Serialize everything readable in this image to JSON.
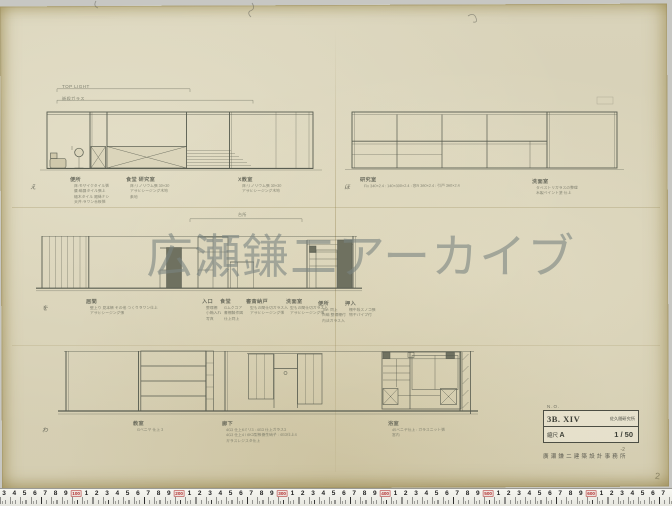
{
  "watermark": "広瀬鎌二アーカイブ",
  "dim_labels": [
    {
      "x": 62,
      "y": 84,
      "fs": 4.6,
      "text": "TOP LIGHT"
    },
    {
      "x": 62,
      "y": 95.5,
      "fs": 4.2,
      "text": "嵌殺ガラス"
    },
    {
      "x": 238,
      "y": 212,
      "fs": 4,
      "text": "台所"
    }
  ],
  "annotations": [
    {
      "x": 30,
      "y": 176,
      "mark": "え"
    },
    {
      "x": 70,
      "y": 176,
      "label": "便所",
      "notes": [
        "床:モザイクタイル張",
        "腰:磁器タイル張上",
        "幅木タイル 廻縁ナシ",
        "天井:ラワン合板張"
      ]
    },
    {
      "x": 126,
      "y": 176,
      "label": "食堂 研究室",
      "notes": [
        "床:リノリウム張 30×30",
        "アサヒシージング木地",
        "素地"
      ]
    },
    {
      "x": 238,
      "y": 176,
      "label": "X教室",
      "notes": [
        "床:リノリウム張 30×30",
        "アサヒシージング木地"
      ]
    },
    {
      "x": 344,
      "y": 176,
      "mark": "ほ"
    },
    {
      "x": 360,
      "y": 176,
      "label": "研究室",
      "notes": [
        "Fix 340×2.4 : 140×300×2.4 : 窓R 360×2.4 : 引戸 360×2.4"
      ]
    },
    {
      "x": 532,
      "y": 178,
      "label": "洗面室",
      "notes": [
        "タペストリガラスの整理",
        "木製ペイント塗 仕上"
      ]
    },
    {
      "x": 42,
      "y": 297,
      "mark": "を"
    },
    {
      "x": 86,
      "y": 298,
      "label": "居間",
      "notes": [
        "壁上り 見本帳 その他 つくりラワン仕上",
        "アサヒシージング張"
      ]
    },
    {
      "x": 202,
      "y": 298,
      "label": "入口",
      "notes": [
        "整理棚",
        "小箱入れ",
        "写真"
      ]
    },
    {
      "x": 220,
      "y": 298,
      "label": "食堂",
      "notes": [
        "Gムクコア",
        "書棚製作図",
        "仕上同上"
      ]
    },
    {
      "x": 246,
      "y": 298,
      "label": "書斎納戸",
      "notes": [
        "型もの間仕切ガラス入",
        "アサヒシージング張"
      ]
    },
    {
      "x": 286,
      "y": 298,
      "label": "洗面室",
      "notes": [
        "型もの間仕切ガラス入",
        "アサヒシージング張"
      ]
    },
    {
      "x": 318,
      "y": 300,
      "label": "便所",
      "notes": [
        "Tile: 同上",
        "白磁 整理棚付",
        "内法ガラス入"
      ]
    },
    {
      "x": 345,
      "y": 300,
      "label": "押入",
      "notes": [
        "棚中段スノコ張",
        "物干パイプ付"
      ]
    },
    {
      "x": 42,
      "y": 419,
      "mark": "わ"
    },
    {
      "x": 133,
      "y": 420,
      "label": "教室",
      "notes": [
        "Gベニヤ 仕上 3"
      ]
    },
    {
      "x": 222,
      "y": 420,
      "label": "廊下",
      "notes": [
        "4G3 仕上6ミリ3 : 4G3 仕上ガラス3",
        "4G3 仕上4 / 6K3型板養生硝子 : 4G3仕上4",
        "ガラスレジスタ仕上"
      ]
    },
    {
      "x": 388,
      "y": 420,
      "label": "浴室",
      "notes": [
        "45ベニヤ仕上 : ガラスニット張",
        "宮内"
      ]
    }
  ],
  "title_block": {
    "no_label": "N.O.",
    "drawing_no": "3B. XIV",
    "client": "佐久間研究所",
    "scale_label": "縮尺",
    "scale_sheet": "A",
    "scale_value": "1 / 50",
    "page_note": "-2",
    "firm": "廣瀬鎌二建築設計事務所"
  },
  "margin_page_number": "2",
  "ruler": {
    "cells": [
      "3",
      "4",
      "5",
      "6",
      "7",
      "8",
      "9",
      "100",
      "1",
      "2",
      "3",
      "4",
      "5",
      "6",
      "7",
      "8",
      "9",
      "200",
      "1",
      "2",
      "3",
      "4",
      "5",
      "6",
      "7",
      "8",
      "9",
      "300",
      "1",
      "2",
      "3",
      "4",
      "5",
      "6",
      "7",
      "8",
      "9",
      "400",
      "1",
      "2",
      "3",
      "4",
      "5",
      "6",
      "7",
      "8",
      "9",
      "500",
      "1",
      "2",
      "3",
      "4",
      "5",
      "6",
      "7",
      "8",
      "9",
      "600",
      "1",
      "2",
      "3",
      "4",
      "5",
      "6",
      "7"
    ],
    "start_x": 4,
    "spacing": 10.3
  }
}
